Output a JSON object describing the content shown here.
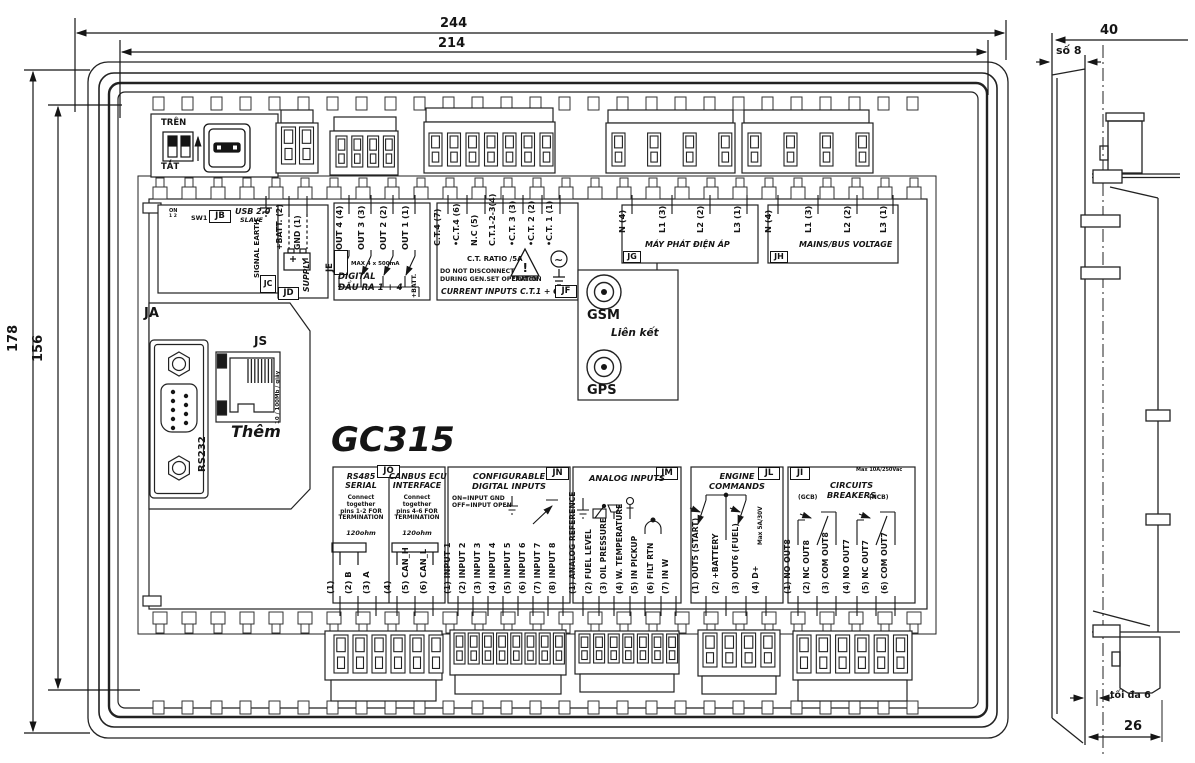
{
  "model": "GC315",
  "dims": {
    "w_outer": "244",
    "w_inner": "214",
    "h_outer": "178",
    "h_inner": "156",
    "depth": "40",
    "bezel": "số 8",
    "clamp": "tối đa 6",
    "body": "26"
  },
  "top_left": {
    "dip_up": "TRÊN",
    "dip_down": "TẮT",
    "dip_on": "ON",
    "dip_nums": "1 2",
    "sw": "SW1",
    "jb": "JB",
    "usb": "USB 2.0",
    "slave": "SLAVE",
    "jc": "JC",
    "signal_earth": "SIGNAL EARTH",
    "jd": "JD",
    "batt": "+BATT. (2)",
    "gnd": "GND (1)",
    "supply": "SUPPLY"
  },
  "ja": {
    "label": "JA",
    "rs232": "RS232",
    "js": "JS",
    "them": "Thêm",
    "speed": "10 / 100Mb / giây"
  },
  "je": {
    "label": "JE",
    "terminals": [
      "OUT 4 (4)",
      "OUT 3 (3)",
      "OUT 2 (2)",
      "OUT 1 (1)"
    ],
    "max": "MAX 4 x 500mA",
    "batt": "+BATT.",
    "title1": "DIGITAL",
    "title2": "ĐẦU RA 1 + 4"
  },
  "jf": {
    "label": "JF",
    "terminals": [
      "C.T.4 (7)",
      "•C.T.4 (6)",
      "N.C (5)",
      "C.T.1-2-3(4)",
      "•C.T. 3 (3)",
      "•C.T. 2 (2)",
      "•C.T. 1 (1)"
    ],
    "ratio": "C.T. RATIO /5A",
    "caution": "CAUTION",
    "excl": "!",
    "tilde": "~",
    "warn1": "DO NOT DISCONNECT",
    "warn2": "DURING GEN.SET OPERATION",
    "title": "CURRENT INPUTS C.T.1 + C.T.4"
  },
  "jg": {
    "label": "JG",
    "terminals": [
      "N (4)",
      "L1 (3)",
      "L2 (2)",
      "L3 (1)"
    ],
    "title": "MÁY PHÁT ĐIỆN ÁP"
  },
  "jh": {
    "label": "JH",
    "terminals": [
      "N (4)",
      "L1 (3)",
      "L2 (2)",
      "L3 (1)"
    ],
    "title": "MAINS/BUS VOLTAGE"
  },
  "comm": {
    "gsm": "GSM",
    "link": "Liên kết",
    "gps": "GPS"
  },
  "jo": {
    "label": "JO",
    "s_title1": "RS485",
    "s_title2": "SERIAL",
    "s_note": [
      "Connect together",
      "pins 1-2 FOR",
      "TERMINATION"
    ],
    "s_res": "120ohm",
    "c_title1": "CANBUS ECU",
    "c_title2": "INTERFACE",
    "c_note": [
      "Connect together",
      "pins 4-6 FOR",
      "TERMINATION"
    ],
    "c_res": "120ohm",
    "terminals": [
      "(1)",
      "(2) B",
      "(3) A",
      "(4)",
      "(5) CAN_H",
      "(6) CAN_L"
    ]
  },
  "jn": {
    "label": "JN",
    "title1": "CONFIGURABLE",
    "title2": "DIGITAL INPUTS",
    "note1": "ON=INPUT GND",
    "note2": "OFF=INPUT OPEN",
    "terminals": [
      "(1) INPUT 1",
      "(2) INPUT 2",
      "(3) INPUT 3",
      "(4) INPUT 4",
      "(5) INPUT 5",
      "(6) INPUT 6",
      "(7) INPUT 7",
      "(8) INPUT 8"
    ]
  },
  "jm": {
    "label": "JM",
    "title": "ANALOG INPUTS",
    "terminals": [
      "(1) ANALOG REFERENCE",
      "(2) FUEL LEVEL",
      "(3) OIL PRESSURE",
      "(4) W. TEMPERATURE",
      "(5) IN PICKUP",
      "(6) FILT RTN",
      "(7) IN W"
    ]
  },
  "jl": {
    "label": "JL",
    "title1": "ENGINE",
    "title2": "COMMANDS",
    "max": "Max 5A/30V",
    "terminals": [
      "(1) OUT5 (START)",
      "(2) +BATTERY",
      "(3) OUT6 (FUEL)",
      "(4) D+"
    ]
  },
  "ji": {
    "label": "JI",
    "title1": "CIRCUITS",
    "title2": "BREAKERS",
    "max": "Max 10A/250Vac",
    "gcb": "(GCB)",
    "ncb": "(NCB)",
    "terminals": [
      "(1) NO OUT8",
      "(2) NC OUT8",
      "(3) COM OUT8",
      "(4) NO OUT7",
      "(5) NC OUT7",
      "(6) COM OUT7"
    ]
  }
}
